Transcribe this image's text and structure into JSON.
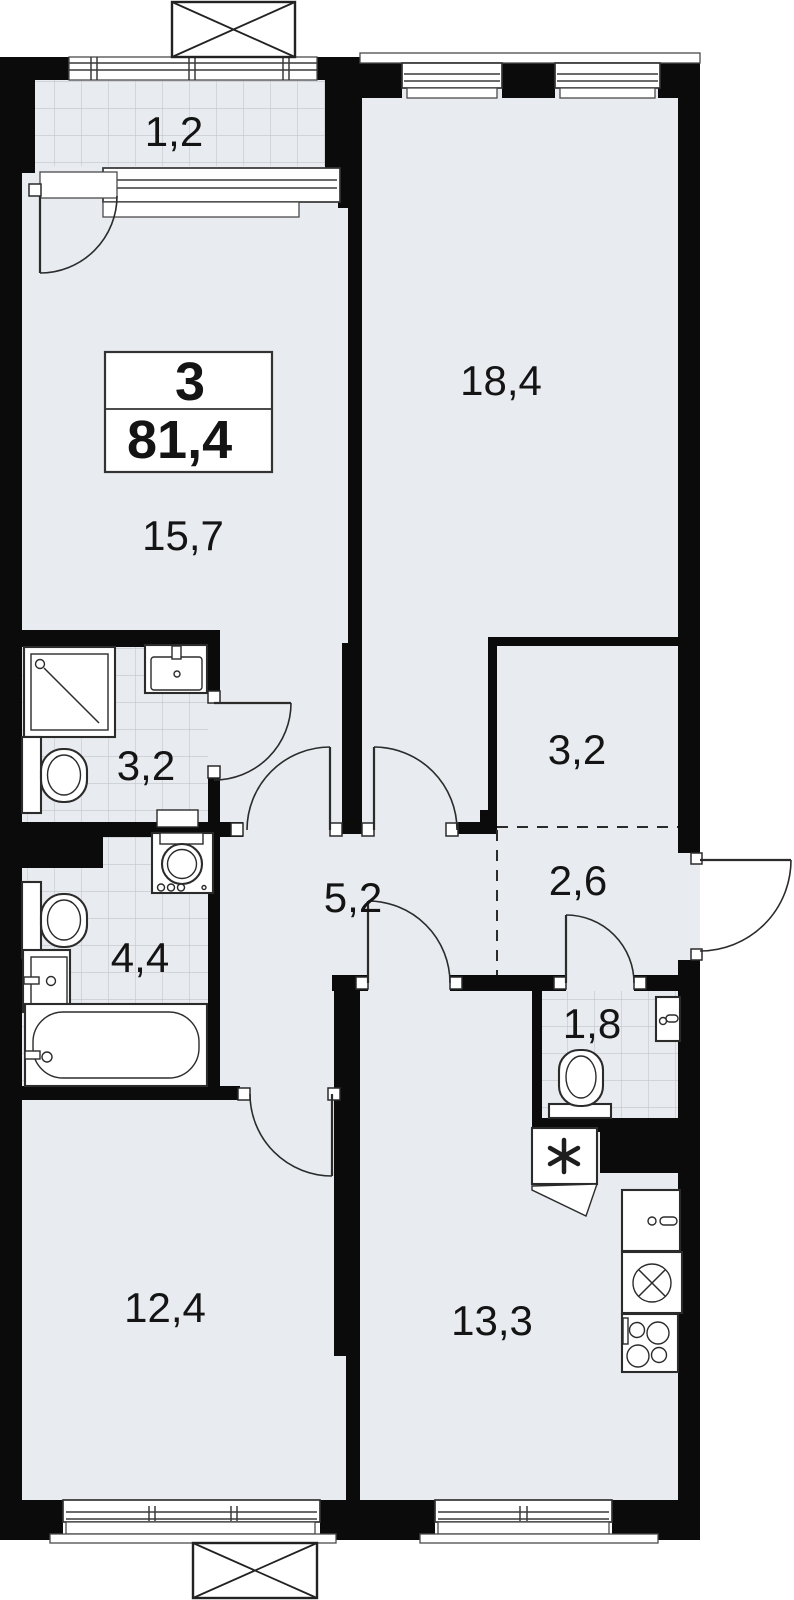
{
  "palette": {
    "wall": "#0b0b0b",
    "floor": "#e8ebef",
    "tile_line": "#c2c7cc",
    "line": "#2b2b2b",
    "text": "#141414",
    "white": "#ffffff"
  },
  "plan": {
    "unit_info": {
      "rooms_count": "3",
      "total_area": "81,4"
    },
    "rooms": [
      {
        "id": "balcony",
        "area": "1,2"
      },
      {
        "id": "living-room",
        "area": "18,4"
      },
      {
        "id": "bedroom",
        "area": "15,7"
      },
      {
        "id": "bathroom",
        "area": "3,2"
      },
      {
        "id": "wardrobe",
        "area": "3,2"
      },
      {
        "id": "hallway",
        "area": "5,2"
      },
      {
        "id": "entrance-hall",
        "area": "2,6"
      },
      {
        "id": "bathroom-2",
        "area": "4,4"
      },
      {
        "id": "wc",
        "area": "1,8"
      },
      {
        "id": "bedroom-2",
        "area": "12,4"
      },
      {
        "id": "kitchen",
        "area": "13,3"
      }
    ]
  }
}
